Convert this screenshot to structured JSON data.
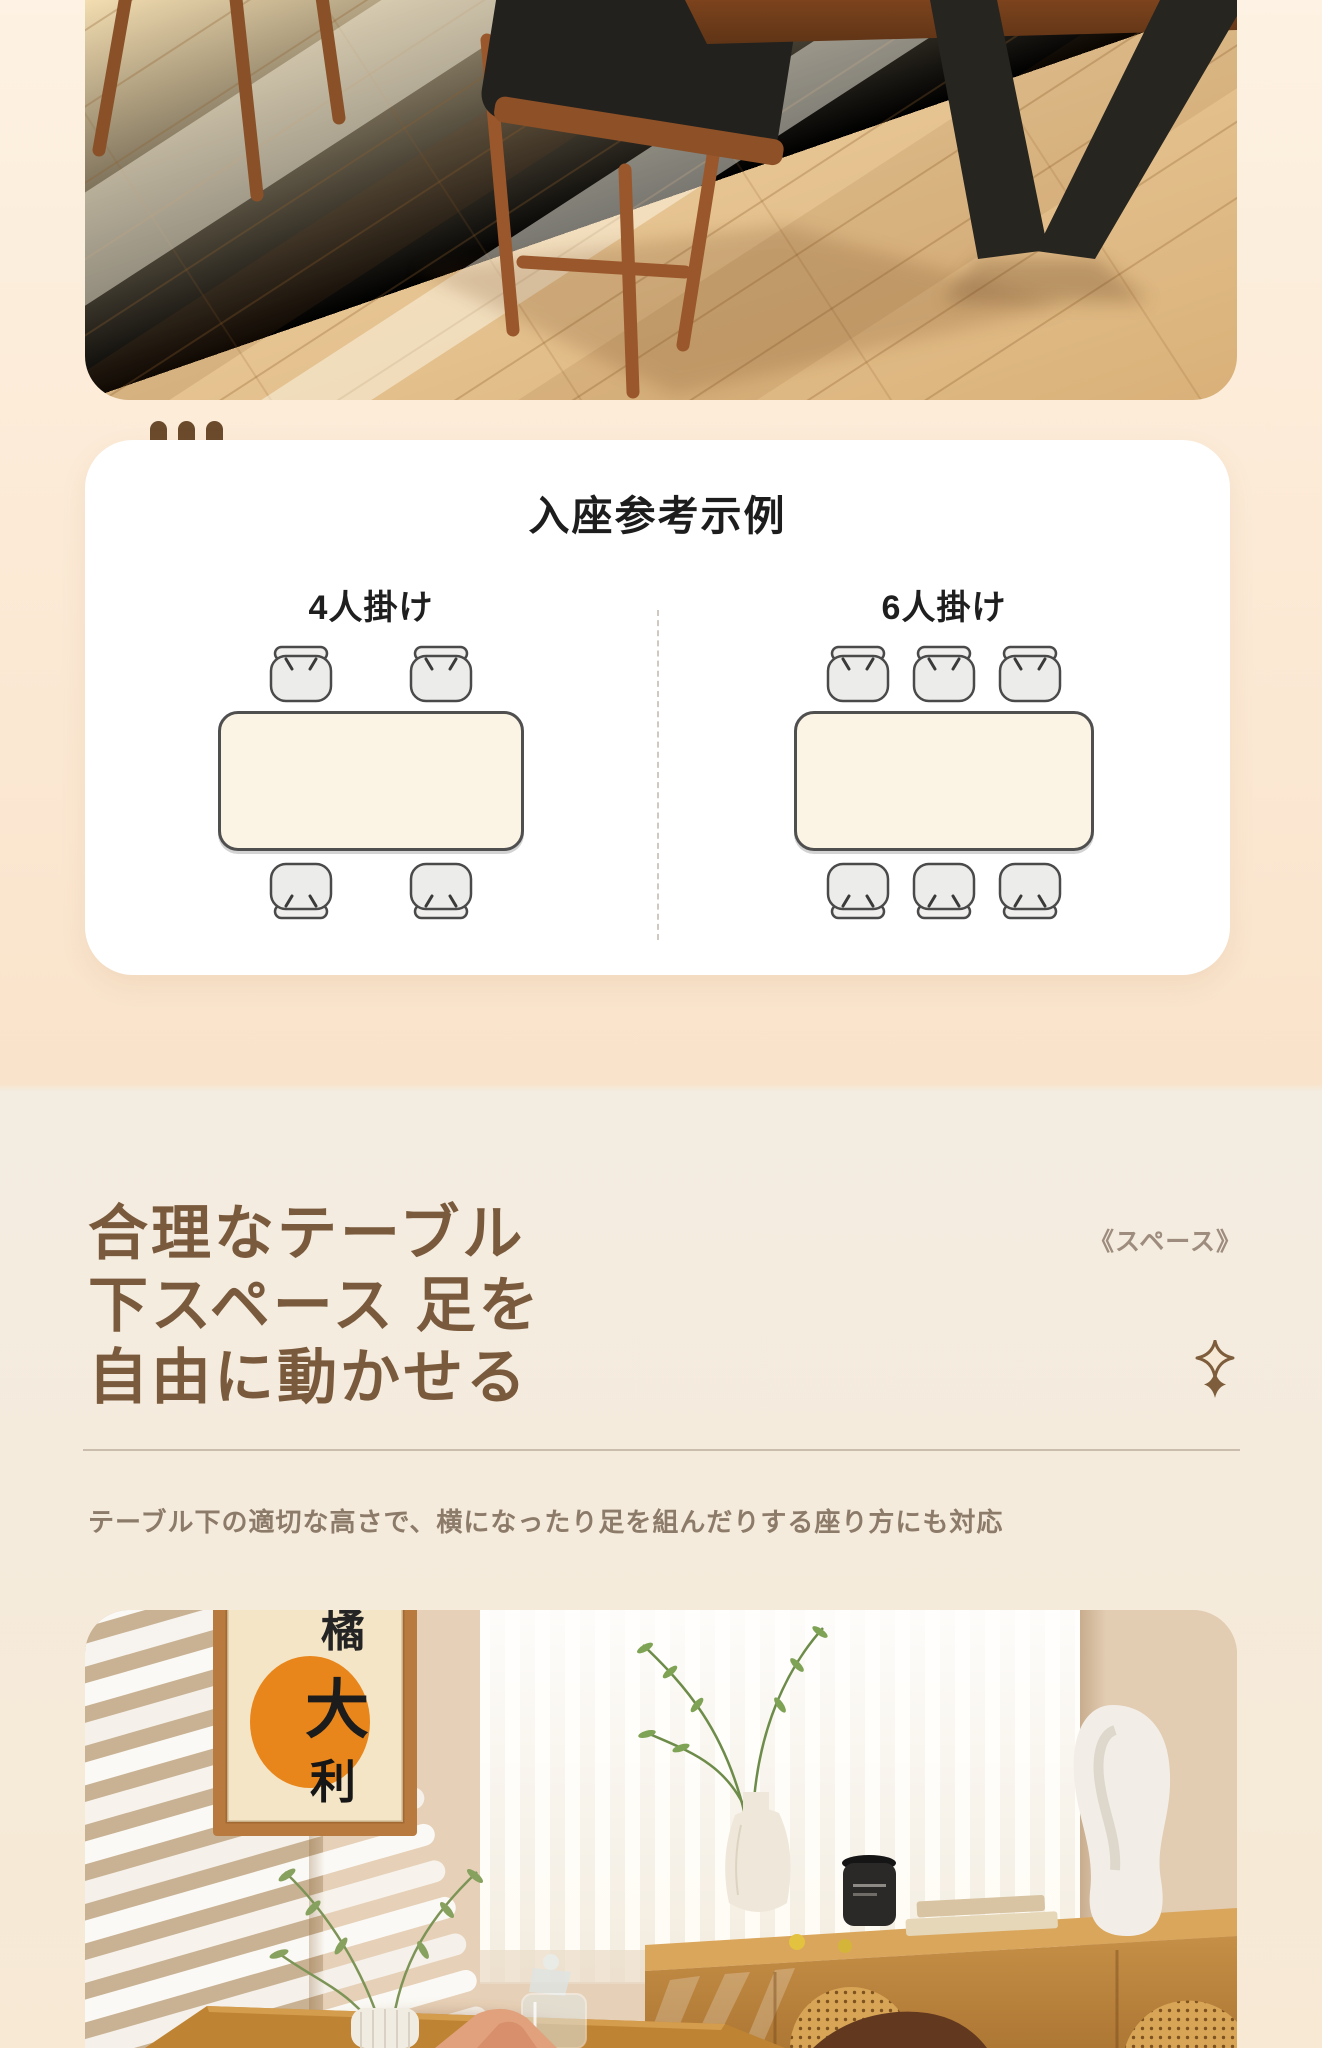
{
  "colors": {
    "page_bg_top": "#fdf2e3",
    "page_bg_warm": "#fbe7d1",
    "feature_band_bg": "#f4ece0",
    "card_bg": "#ffffff",
    "dots_brown": "#6b4a2c",
    "title_brown": "#7a5a3c",
    "tag_brown": "#9e8d7e",
    "description_brown": "#8d7b6a",
    "diagram_outline": "#4f4f4f",
    "diagram_table_fill": "#fbf3e3",
    "chair_fill": "#ececea",
    "poster_orange": "#e8861b"
  },
  "seating_card": {
    "heading": "入座参考示例",
    "diagrams": [
      {
        "label": "4人掛け",
        "seats_top": 2,
        "seats_bottom": 2
      },
      {
        "label": "6人掛け",
        "seats_top": 3,
        "seats_bottom": 3
      }
    ]
  },
  "feature_section": {
    "tag": "《スペース》",
    "title_lines": [
      "合理なテーブル",
      "下スペース 足を",
      "自由に動かせる"
    ],
    "description": "テーブル下の適切な高さで、横になったり足を組んだりする座り方にも対応"
  },
  "bottom_photo": {
    "poster_chars": "橘大利"
  },
  "icons": {
    "sparkle": "four-point-star",
    "card_dots_count": 3
  }
}
